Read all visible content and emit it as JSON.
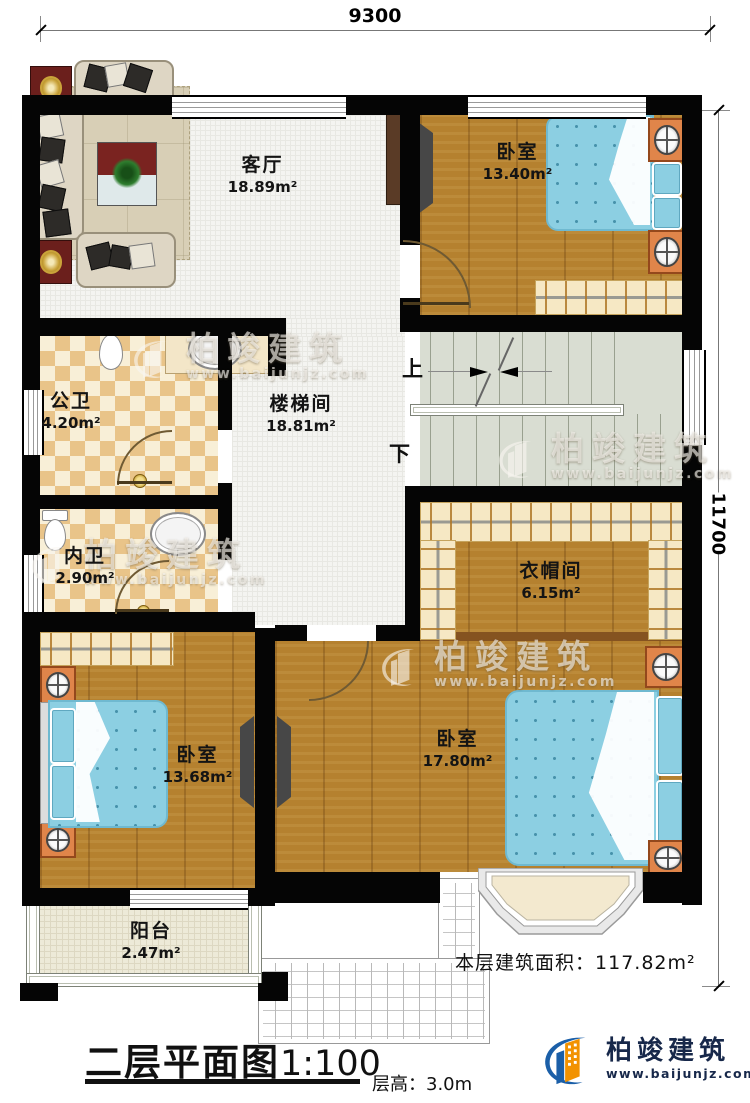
{
  "dims": {
    "top": "9300",
    "right": "11700"
  },
  "rooms": {
    "living": {
      "name": "客厅",
      "area": "18.89m²"
    },
    "bedroom1": {
      "name": "卧室",
      "area": "13.40m²"
    },
    "public_bath": {
      "name": "公卫",
      "area": "4.20m²"
    },
    "stair_hall": {
      "name": "楼梯间",
      "area": "18.81m²"
    },
    "private_bath": {
      "name": "内卫",
      "area": "2.90m²"
    },
    "cloakroom": {
      "name": "衣帽间",
      "area": "6.15m²"
    },
    "bedroom2": {
      "name": "卧室",
      "area": "13.68m²"
    },
    "bedroom3": {
      "name": "卧室",
      "area": "17.80m²"
    },
    "balcony": {
      "name": "阳台",
      "area": "2.47m²"
    }
  },
  "stairs": {
    "up": "上",
    "down": "下"
  },
  "footer": {
    "floor_area_label": "本层建筑面积：",
    "floor_area_value": "117.82m²",
    "plan_title": "二层平面图",
    "plan_scale": "1:100",
    "floor_height_label": "层高：",
    "floor_height_value": "3.0m"
  },
  "brand": {
    "name": "柏竣建筑",
    "url": "www.baijunjz.com"
  },
  "watermark": {
    "name": "柏竣建筑",
    "url": "www.baijunjz.com"
  },
  "colors": {
    "wall": "#050505",
    "wood_floor": "#b5812f",
    "tile_dark": "#e9c489",
    "tile_light": "#f8efd7",
    "bed_blue": "#8ccfe2",
    "stairs": "#d9ddd2",
    "furniture_orange": "#e0854a",
    "logo_blue": "#1b5fa8",
    "logo_orange": "#f29200",
    "logo_text": "#17284a"
  }
}
